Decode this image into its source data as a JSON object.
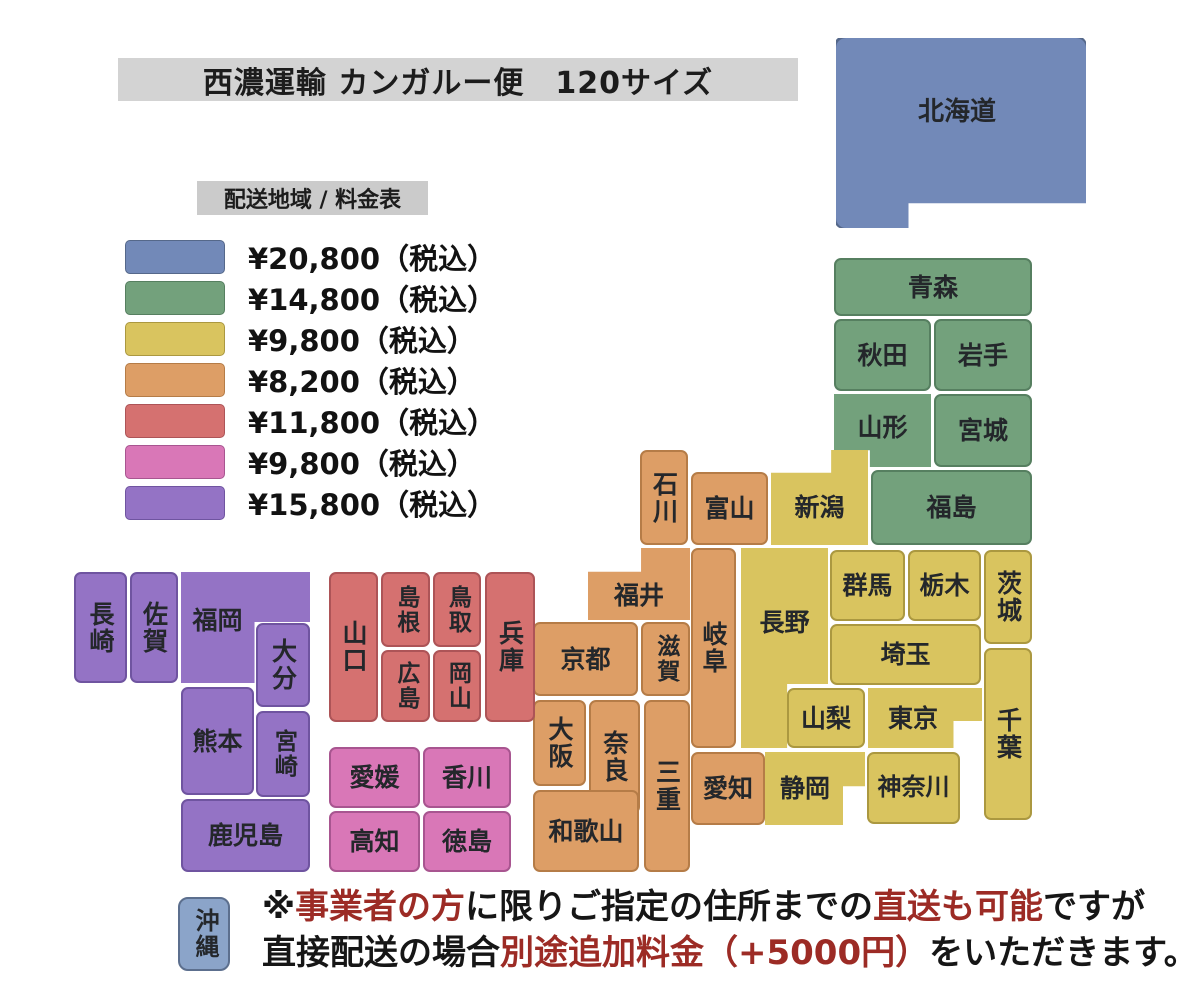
{
  "title": "西濃運輸 カンガルー便　120サイズ",
  "legend": {
    "header": "配送地域 / 料金表",
    "rows": [
      {
        "zone": "blue",
        "price": "¥20,800（税込）"
      },
      {
        "zone": "green",
        "price": "¥14,800（税込）"
      },
      {
        "zone": "yellow",
        "price": "¥9,800（税込）"
      },
      {
        "zone": "orange",
        "price": "¥8,200（税込）"
      },
      {
        "zone": "red",
        "price": "¥11,800（税込）"
      },
      {
        "zone": "pink",
        "price": "¥9,800（税込）"
      },
      {
        "zone": "purple",
        "price": "¥15,800（税込）"
      }
    ]
  },
  "colors": {
    "blue": {
      "fill": "#7289b8",
      "border": "#55688a"
    },
    "blue_light": {
      "fill": "#8ba4c9",
      "border": "#5c6f8e"
    },
    "green": {
      "fill": "#73a17c",
      "border": "#567f60"
    },
    "yellow": {
      "fill": "#d9c45f",
      "border": "#ab9840"
    },
    "orange": {
      "fill": "#dd9e66",
      "border": "#b57c47"
    },
    "red": {
      "fill": "#d57170",
      "border": "#ad5457"
    },
    "pink": {
      "fill": "#d977b7",
      "border": "#a85590"
    },
    "purple": {
      "fill": "#9473c5",
      "border": "#6f54a0"
    },
    "note_red": "#9c2b25"
  },
  "map": {
    "hokkaido": "北海道",
    "aomori": "青森",
    "akita": "秋田",
    "iwate": "岩手",
    "yamagata": "山形",
    "miyagi": "宮城",
    "fukushima": "福島",
    "niigata": "新潟",
    "ishikawa": "石川",
    "toyama": "富山",
    "fukui": "福井",
    "gifu": "岐阜",
    "nagano": "長野",
    "gunma": "群馬",
    "tochigi": "栃木",
    "ibaraki": "茨城",
    "saitama": "埼玉",
    "yamanashi": "山梨",
    "tokyo": "東京",
    "chiba": "千葉",
    "kanagawa": "神奈川",
    "shizuoka": "静岡",
    "aichi": "愛知",
    "kyoto": "京都",
    "shiga": "滋賀",
    "osaka": "大阪",
    "nara": "奈良",
    "mie": "三重",
    "wakayama": "和歌山",
    "hyogo": "兵庫",
    "tottori": "鳥取",
    "shimane": "島根",
    "okayama": "岡山",
    "hiroshima": "広島",
    "yamaguchi": "山口",
    "ehime": "愛媛",
    "kagawa": "香川",
    "kochi": "高知",
    "tokushima": "徳島",
    "nagasaki": "長崎",
    "saga": "佐賀",
    "fukuoka": "福岡",
    "oita": "大分",
    "kumamoto": "熊本",
    "miyazaki": "宮崎",
    "kagoshima": "鹿児島",
    "okinawa": "沖縄"
  },
  "note": {
    "line1": [
      {
        "t": "※"
      },
      {
        "t": "事業者の方"
      },
      {
        "t": "に限りご指定の住所までの"
      },
      {
        "t": "直送も可能"
      },
      {
        "t": "ですが"
      }
    ],
    "line2": [
      {
        "t": "直接配送の場合"
      },
      {
        "t": "別途追加料金（+5000円）"
      },
      {
        "t": "をいただきます。"
      }
    ]
  }
}
